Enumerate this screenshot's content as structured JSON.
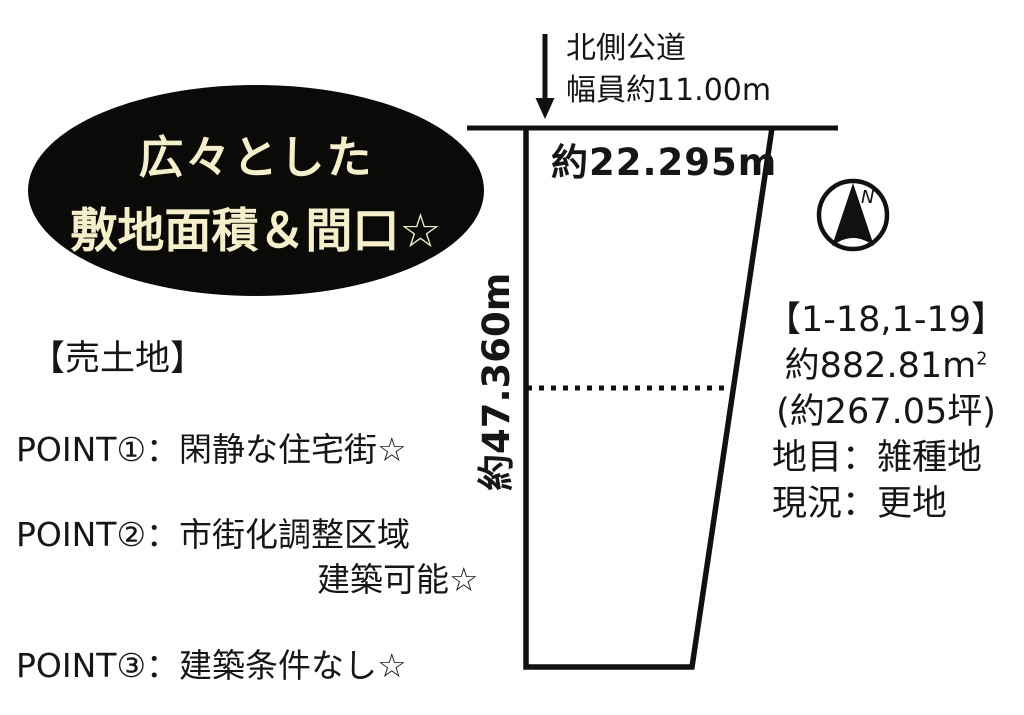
{
  "badge": {
    "line1": "広々とした",
    "line2": "敷地面積＆間口☆"
  },
  "listing": {
    "label": "【売土地】",
    "points": [
      {
        "text": "POINT①：閑静な住宅街☆"
      },
      {
        "text": "POINT②：市街化調整区域",
        "text2": "建築可能☆"
      },
      {
        "text": "POINT③：建築条件なし☆"
      }
    ]
  },
  "road": {
    "name": "北側公道",
    "width_label": "幅員約11.00m"
  },
  "plot": {
    "frontage_label": "約22.295m",
    "depth_label": "約47.360m",
    "lot_numbers": "【1-18,1-19】",
    "area_sqm_prefix": "約882.81",
    "area_sqm_unit": "m",
    "area_sqm_sup": "2",
    "area_tsubo": "(約267.05坪)",
    "land_category": "地目：雑種地",
    "current_status": "現況：更地"
  },
  "compass": {
    "label": "N"
  },
  "colors": {
    "ink": "#111111",
    "badge_bg": "#0a0a08",
    "badge_text": "#f5f0c8"
  }
}
